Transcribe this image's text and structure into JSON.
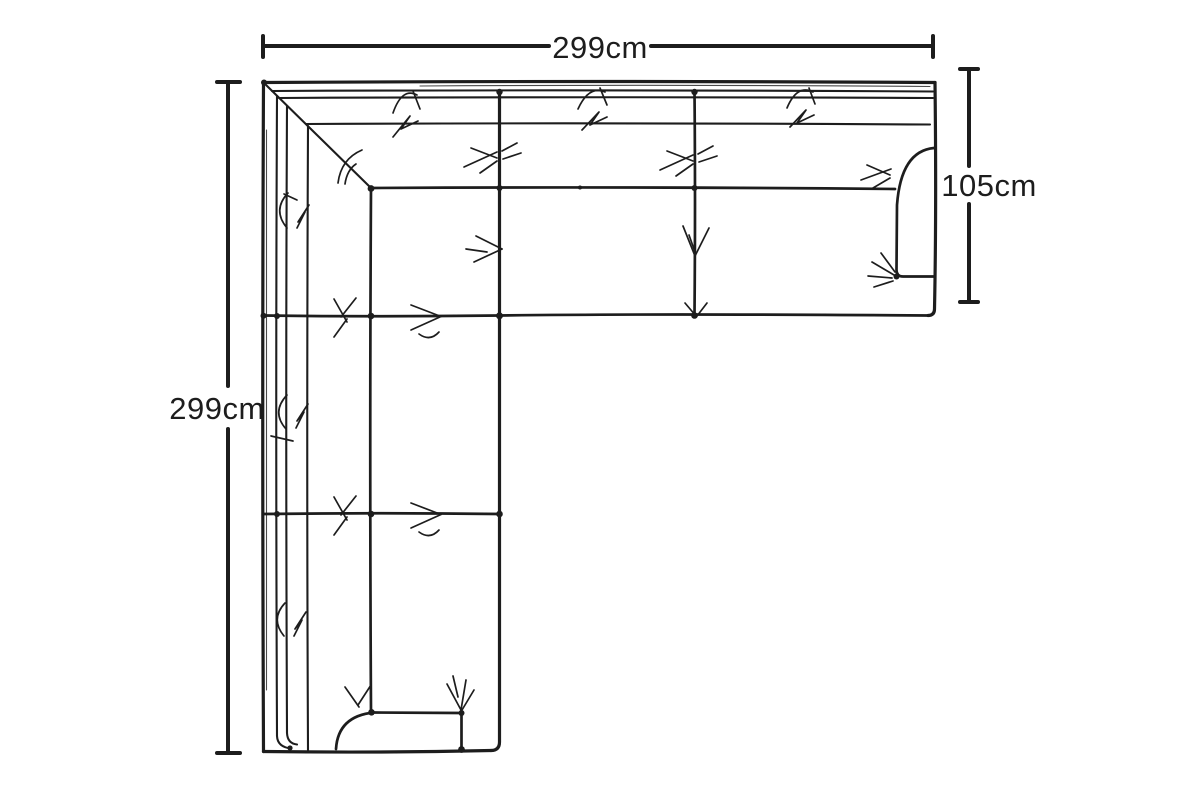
{
  "meta": {
    "background_color": "#ffffff",
    "ink_color": "#1d1d1d"
  },
  "diagram": {
    "dimensions": {
      "top": {
        "label": "299cm"
      },
      "left": {
        "label": "299cm"
      },
      "right": {
        "label": "105cm"
      }
    }
  }
}
